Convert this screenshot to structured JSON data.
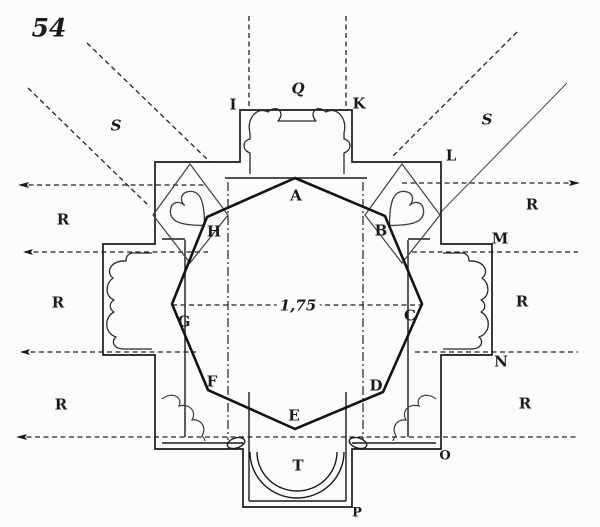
{
  "colors": {
    "ink": "#1b1b1b",
    "paper": "#fcfcfa",
    "thin_line": "#3f3f3f"
  },
  "plan": {
    "figure_number": "54",
    "dimension_label": "1,75",
    "octagon_vertices": [
      "A",
      "B",
      "C",
      "D",
      "E",
      "F",
      "G",
      "H"
    ],
    "perimeter_points": [
      "I",
      "Q",
      "K",
      "L",
      "M",
      "N",
      "O",
      "P"
    ],
    "apse_label": "T",
    "region_labels": {
      "left": [
        "R",
        "R",
        "R"
      ],
      "right": [
        "R",
        "R",
        "R"
      ]
    },
    "diagonal_labels": [
      "S",
      "S"
    ]
  }
}
